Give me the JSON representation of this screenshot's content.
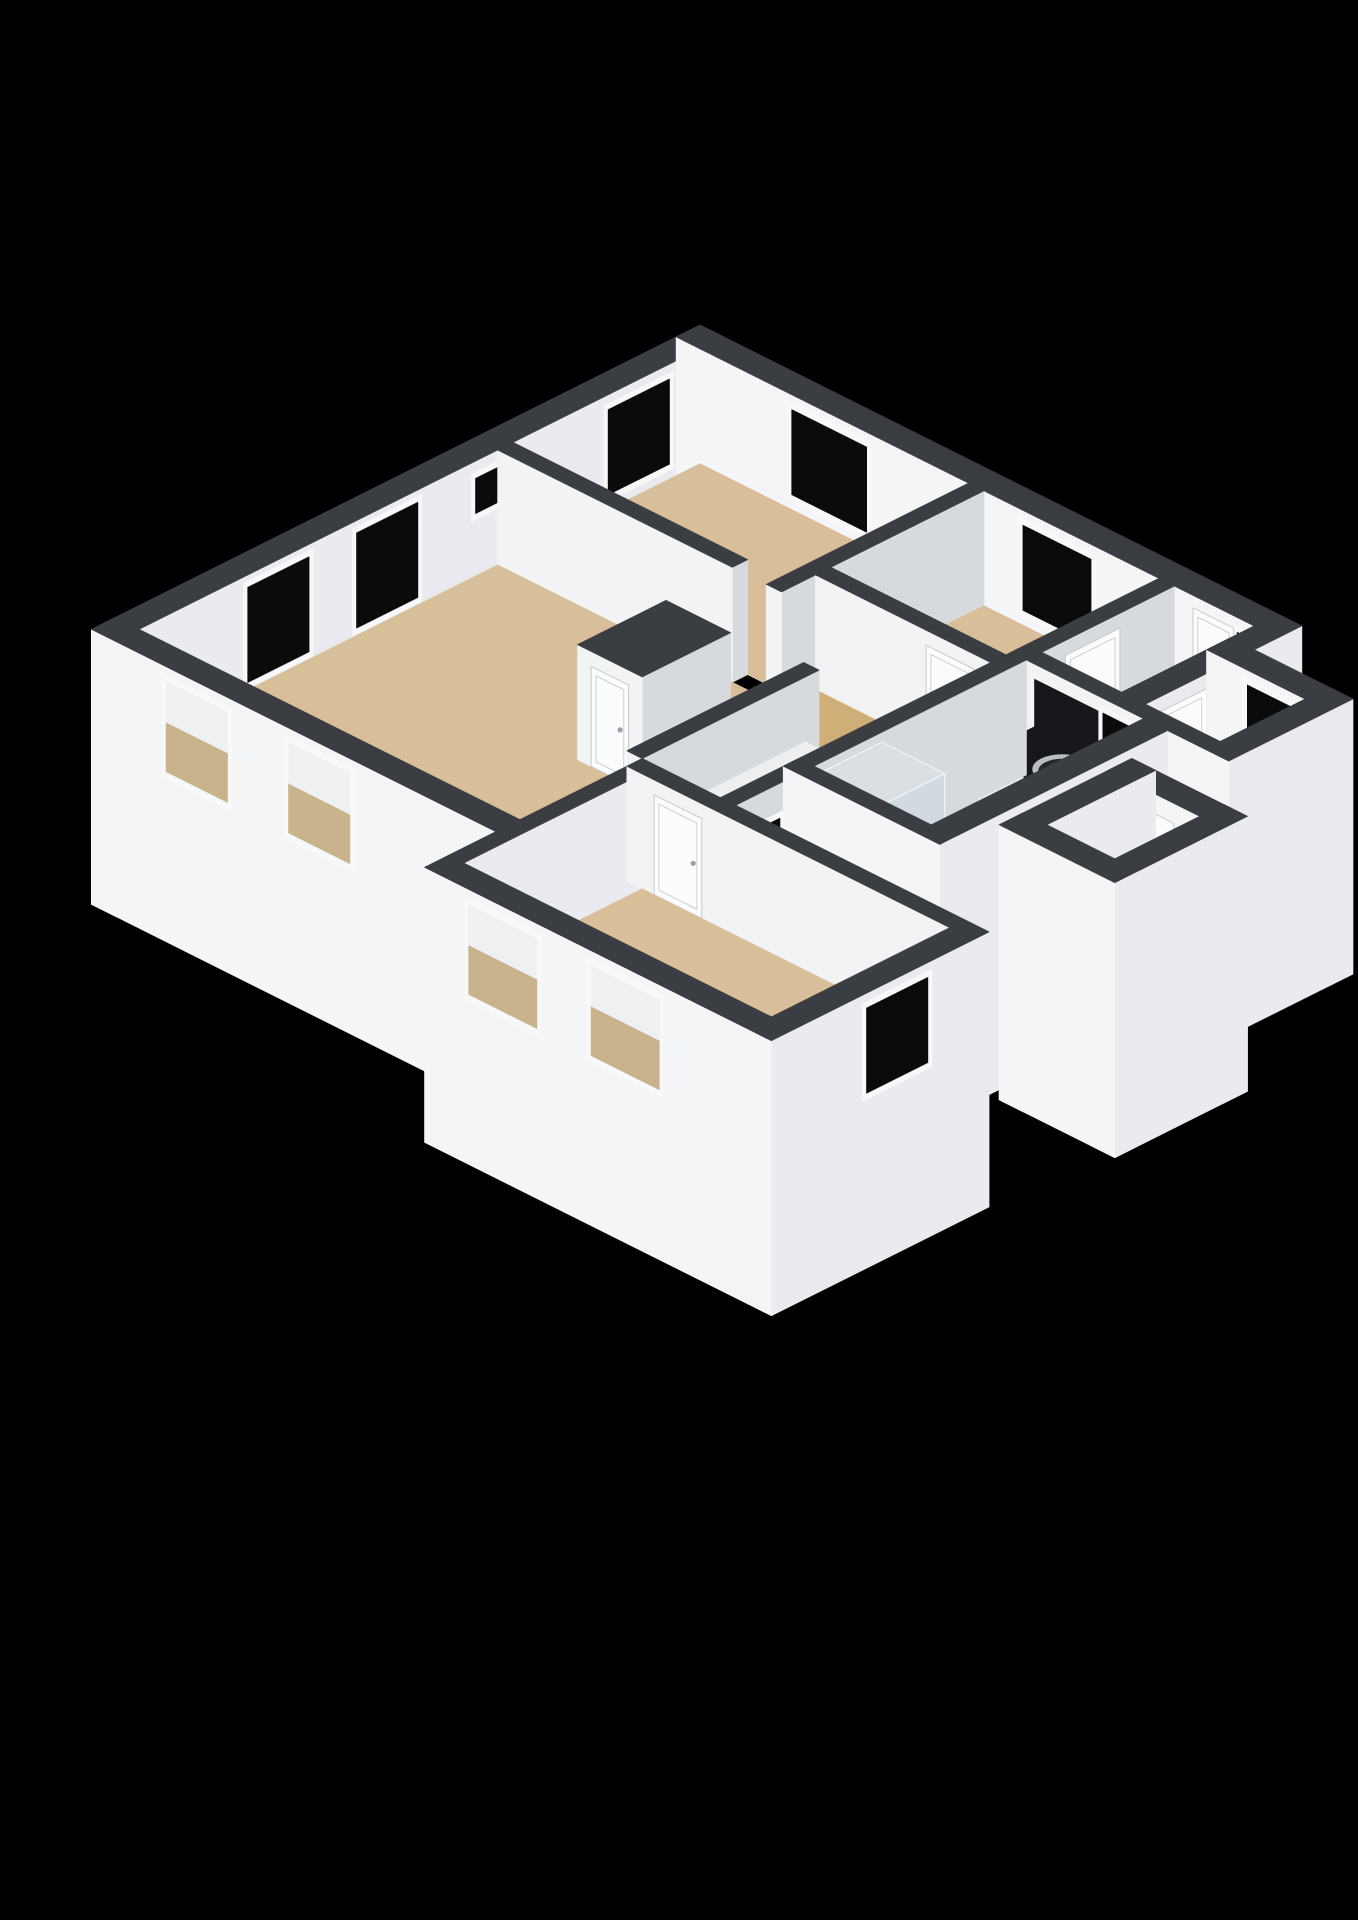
{
  "meta": {
    "type": "isometric-3d-floorplan",
    "background": "#000000"
  },
  "palette": {
    "bg": "#000000",
    "wallTop": "#3a3d41",
    "extFaceY": "#f4f5f7",
    "extFaceX": "#e9ebee",
    "intFaceY": "#f1f3f5",
    "intFaceX": "#d6dadd",
    "floorTan": "#d8bf99",
    "floorHall": "#cfae78",
    "floorBath": "#ccd7e1",
    "floorToilet": "#e1e4e6",
    "floorEntrance": "#e4e5e4",
    "glassDark": "#0a0b0c",
    "frame": "#f7f8fa",
    "openTop": "#eef0f2",
    "openBottom": "#c9b38c",
    "door": "#fbfcfd",
    "doorStroke": "#c6cacd",
    "handle": "#9aa0a5",
    "counterTop": "#15171a",
    "boxSideY": "#f2f3f5",
    "boxSideX": "#e6e8ea",
    "cabinetTop": "#edeff1",
    "showerFill": "rgba(206,220,231,0.42)",
    "showerTopFill": "rgba(228,238,245,0.25)",
    "showerEdge": "#eef2f5",
    "sinkRim": "#b9bdc1",
    "sinkBowl": "#26282b",
    "sinkInner": "#3c3f43",
    "metal": "#c9cdd0"
  },
  "projection": {
    "a": 34,
    "b": 17,
    "h": 50,
    "cx": 700,
    "cy": 440,
    "wallHeight": 2.3,
    "skirt": -3.2
  },
  "floors": [
    {
      "n": "floor-bedroom1",
      "x0": 0.7,
      "y0": 0.7,
      "x1": 8.6,
      "y1": 6.2,
      "c": "floorTan",
      "key": 8.1
    },
    {
      "n": "floor-bedroom2",
      "x0": 9.05,
      "y0": 0.7,
      "x1": 14.2,
      "y1": 5.2,
      "c": "floorTan"
    },
    {
      "n": "floor-entrance",
      "x0": 14.65,
      "y0": 0.7,
      "x1": 17.0,
      "y1": 4.6,
      "c": "floorEntrance"
    },
    {
      "n": "floor-toilet",
      "x0": 17.7,
      "y0": 2.1,
      "x1": 19.9,
      "y1": 4.6,
      "c": "floorToilet"
    },
    {
      "n": "floor-bathroom",
      "x0": 14.65,
      "y0": 5.05,
      "x1": 18.1,
      "y1": 11.3,
      "c": "floorBath",
      "key": 20
    },
    {
      "n": "floor-hall",
      "x0": 9.05,
      "y0": 5.65,
      "x1": 14.2,
      "y1": 13.6,
      "c": "floorHall"
    },
    {
      "n": "floor-living",
      "x0": 0.7,
      "y0": 6.65,
      "x1": 11.9,
      "y1": 17.2,
      "c": "floorTan"
    },
    {
      "n": "floor-bedroom3",
      "x0": 12.35,
      "y0": 14.05,
      "x1": 21.4,
      "y1": 19.3,
      "c": "floorTan"
    },
    {
      "n": "floor-storage",
      "x0": 19.8,
      "y0": 7.1,
      "x1": 21.8,
      "y1": 9.6,
      "c": "floorTan"
    }
  ],
  "walls": [
    {
      "n": "wall-nw-facade",
      "x0": 0,
      "y0": 0,
      "x1": 0.7,
      "y1": 17.9,
      "ext": true,
      "key": 5
    },
    {
      "n": "wall-ne-facade",
      "x0": 0,
      "y0": 0,
      "x1": 17.35,
      "y1": 0.7,
      "ext": true,
      "key": 5.05
    },
    {
      "n": "wall-entrance-east",
      "x0": 17.0,
      "y0": 0,
      "x1": 17.7,
      "y1": 5.05,
      "ext": true
    },
    {
      "n": "wall-toilet-north",
      "x0": 17.0,
      "y0": 1.4,
      "x1": 20.6,
      "y1": 2.1,
      "ext": true
    },
    {
      "n": "wall-toilet-east",
      "x0": 19.9,
      "y0": 1.4,
      "x1": 20.6,
      "y1": 5.05,
      "ext": true
    },
    {
      "n": "wall-bathroom-north",
      "x0": 14.2,
      "y0": 4.6,
      "x1": 18.8,
      "y1": 5.05,
      "ext": false
    },
    {
      "n": "wall-toilet-south",
      "x0": 18.8,
      "y0": 4.6,
      "x1": 20.6,
      "y1": 5.05,
      "ext": true
    },
    {
      "n": "wall-bathroom-east",
      "x0": 18.1,
      "y0": 5.05,
      "x1": 18.8,
      "y1": 11.75,
      "ext": true
    },
    {
      "n": "wall-bathroom-south",
      "x0": 14.2,
      "y0": 11.3,
      "x1": 18.8,
      "y1": 11.75,
      "ext": true
    },
    {
      "n": "wall-corridor-bathroom",
      "x0": 14.2,
      "y0": 5.05,
      "x1": 14.65,
      "y1": 14.05,
      "ext": false
    },
    {
      "n": "wall-bedroom3-north",
      "x0": 11.9,
      "y0": 13.6,
      "x1": 21.4,
      "y1": 14.05,
      "ext": false
    },
    {
      "n": "wall-living-sw-facade",
      "x0": 0,
      "y0": 17.2,
      "x1": 12.35,
      "y1": 17.9,
      "ext": true
    },
    {
      "n": "wall-bedroom3-west",
      "x0": 11.9,
      "y0": 14.05,
      "x1": 12.35,
      "y1": 19.3,
      "ext": true
    },
    {
      "n": "wall-bedroom3-sw-facade",
      "x0": 11.9,
      "y0": 19.3,
      "x1": 21.4,
      "y1": 20.0,
      "ext": true
    },
    {
      "n": "wall-bedroom3-east",
      "x0": 21.4,
      "y0": 13.6,
      "x1": 22.1,
      "y1": 20.0,
      "ext": true
    },
    {
      "n": "wall-living-bedroom1",
      "x0": 0.7,
      "y0": 6.2,
      "x1": 7.6,
      "y1": 6.65,
      "ext": false
    },
    {
      "n": "wall-bedroom1-bedroom2",
      "x0": 8.6,
      "y0": 0.7,
      "x1": 9.05,
      "y1": 6.65,
      "ext": false
    },
    {
      "n": "wall-bedroom2-south",
      "x0": 9.05,
      "y0": 5.2,
      "x1": 14.2,
      "y1": 5.65,
      "ext": false
    },
    {
      "n": "wall-bedroom2-entrance",
      "x0": 14.2,
      "y0": 0.7,
      "x1": 14.65,
      "y1": 5.2,
      "ext": false
    },
    {
      "n": "wall-living-corridor",
      "x0": 11.45,
      "y0": 8.4,
      "x1": 11.9,
      "y1": 13.6,
      "ext": false
    },
    {
      "n": "wall-storage-north",
      "x0": 19.1,
      "y0": 6.4,
      "x1": 22.5,
      "y1": 7.1,
      "ext": true
    },
    {
      "n": "wall-storage-east",
      "x0": 21.8,
      "y0": 6.4,
      "x1": 22.5,
      "y1": 10.3,
      "ext": true
    },
    {
      "n": "wall-storage-south",
      "x0": 19.1,
      "y0": 9.6,
      "x1": 22.5,
      "y1": 10.3,
      "ext": true
    },
    {
      "n": "wall-storage-west",
      "x0": 19.1,
      "y0": 6.4,
      "x1": 19.8,
      "y1": 10.3,
      "ext": true
    }
  ],
  "boxes": [
    {
      "n": "closet-box",
      "x0": 7.6,
      "y0": 8.6,
      "x1": 9.5,
      "y1": 11.2,
      "z0": 0,
      "z1": 2.3,
      "top": "wallTop",
      "fy": "intFaceY",
      "fx": "intFaceX"
    },
    {
      "n": "bathroom-counter",
      "x0": 14.9,
      "y0": 5.05,
      "x1": 18.1,
      "y1": 6.7,
      "z0": 0,
      "z1": 1.05,
      "top": "counterTop",
      "fy": "boxSideY",
      "fx": "boxSideX"
    },
    {
      "n": "hall-cabinet",
      "x0": 11.9,
      "y0": 8.8,
      "x1": 12.7,
      "y1": 13.2,
      "z0": 0,
      "z1": 1.0,
      "top": "cabinetTop",
      "fy": "boxSideY",
      "fx": "boxSideX"
    },
    {
      "n": "shower-enclosure",
      "x0": 14.65,
      "y0": 9.3,
      "x1": 16.5,
      "y1": 11.3,
      "z0": 0,
      "z1": 2.1,
      "glass": true
    }
  ],
  "decals": [
    {
      "n": "window-bedroom1-nw-icon",
      "kind": "window-dark",
      "face": "x",
      "v": 0.7,
      "a0": 1.6,
      "a1": 3.4,
      "z0": 0.3,
      "z1": 2.0,
      "key": 5.15
    },
    {
      "n": "window-living-small-icon",
      "kind": "window-dark",
      "face": "x",
      "v": 0.7,
      "a0": 6.3,
      "a1": 7.3,
      "z0": 1.25,
      "z1": 1.95,
      "key": 5.16
    },
    {
      "n": "window-living-nw-1-icon",
      "kind": "window-dark",
      "face": "x",
      "v": 0.7,
      "a0": 9.0,
      "a1": 10.8,
      "z0": 0.15,
      "z1": 2.05,
      "key": 5.17
    },
    {
      "n": "window-living-nw-2-icon",
      "kind": "window-dark",
      "face": "x",
      "v": 0.7,
      "a0": 12.2,
      "a1": 14.0,
      "z0": 0.15,
      "z1": 2.05,
      "key": 5.18
    },
    {
      "n": "window-bedroom1-ne-icon",
      "kind": "window-dark",
      "face": "y",
      "v": 0.7,
      "a0": 3.4,
      "a1": 5.6,
      "z0": 0.3,
      "z1": 2.0,
      "key": 5.2
    },
    {
      "n": "window-bedroom2-ne-icon",
      "kind": "window-dark",
      "face": "y",
      "v": 0.7,
      "a0": 10.2,
      "a1": 12.2,
      "z0": 0.3,
      "z1": 2.0,
      "key": 5.21
    },
    {
      "n": "window-entrance-side-icon",
      "kind": "window-dark",
      "face": "y",
      "v": 0.7,
      "a0": 16.5,
      "a1": 17.2,
      "z0": 0.3,
      "z1": 2.0,
      "key": 5.22
    },
    {
      "n": "door-entrance",
      "kind": "door",
      "face": "y",
      "v": 0.7,
      "a0": 15.2,
      "a1": 16.4,
      "z0": 0,
      "z1": 2.05,
      "key": 5.23
    },
    {
      "n": "door-toilet",
      "kind": "door",
      "face": "x",
      "v": 17.7,
      "a0": 2.8,
      "a1": 4.2,
      "z0": 0,
      "z1": 2.0,
      "key": 20.03
    },
    {
      "n": "window-toilet-icon",
      "kind": "window-dark",
      "face": "y",
      "v": 2.1,
      "a0": 18.2,
      "a1": 19.6,
      "z0": 0.5,
      "z1": 2.0,
      "key": 20.7
    },
    {
      "n": "bathroom-backsplash",
      "kind": "panel",
      "face": "y",
      "v": 5.06,
      "a0": 14.9,
      "a1": 18.05,
      "z0": 1.05,
      "z1": 2.0,
      "key": 21.48,
      "c": "counterTop"
    },
    {
      "n": "window-bathroom-icon",
      "kind": "window-dark",
      "face": "y",
      "v": 5.05,
      "a0": 16.9,
      "a1": 17.8,
      "z0": 0.9,
      "z1": 2.0,
      "key": 21.55
    },
    {
      "n": "door-bedroom2",
      "kind": "door",
      "face": "y",
      "v": 5.65,
      "a0": 12.3,
      "a1": 13.7,
      "z0": 0,
      "z1": 2.0,
      "key": 17.2
    },
    {
      "n": "door-bedroom2-entrance",
      "kind": "door",
      "face": "x",
      "v": 14.65,
      "a0": 2.3,
      "a1": 3.9,
      "z0": 0,
      "z1": 2.0,
      "key": 17.53
    },
    {
      "n": "door-closet",
      "kind": "door",
      "face": "y",
      "v": 11.2,
      "a0": 8.0,
      "a1": 9.1,
      "z0": 0,
      "z1": 2.0,
      "key": 18.6
    },
    {
      "n": "window-corridor-small-icon",
      "kind": "window-dark",
      "face": "x",
      "v": 14.65,
      "a0": 12.3,
      "a1": 13.2,
      "z0": 0.8,
      "z1": 1.6,
      "key": 24.13
    },
    {
      "n": "window-living-sw-1-icon",
      "kind": "window-open",
      "face": "y",
      "v": 17.9,
      "a0": 2.2,
      "a1": 4.0,
      "z0": 0.2,
      "z1": 2.0,
      "key": 23.88
    },
    {
      "n": "window-living-sw-2-icon",
      "kind": "window-open",
      "face": "y",
      "v": 17.9,
      "a0": 5.8,
      "a1": 7.6,
      "z0": 0.2,
      "z1": 2.0,
      "key": 23.89
    },
    {
      "n": "door-leaf-storage",
      "kind": "leaf",
      "face": "y",
      "v": 7.1,
      "a0": 20.15,
      "a1": 21.25,
      "z0": 0.05,
      "z1": 1.9,
      "key": 27.7
    },
    {
      "n": "door-bedroom3",
      "kind": "door",
      "face": "y",
      "v": 14.05,
      "a0": 12.7,
      "a1": 14.1,
      "z0": 0,
      "z1": 2.0,
      "key": 30.63
    },
    {
      "n": "window-bedroom3-sw-1-icon",
      "kind": "window-open",
      "face": "y",
      "v": 20.0,
      "a0": 13.2,
      "a1": 15.2,
      "z0": 0.2,
      "z1": 2.0,
      "key": 36.45
    },
    {
      "n": "window-bedroom3-sw-2-icon",
      "kind": "window-open",
      "face": "y",
      "v": 20.0,
      "a0": 16.8,
      "a1": 18.8,
      "z0": 0.2,
      "z1": 2.0,
      "key": 36.46
    },
    {
      "n": "window-bedroom3-se-icon",
      "kind": "window-dark",
      "face": "x",
      "v": 22.1,
      "a0": 15.4,
      "a1": 17.2,
      "z0": 0.3,
      "z1": 2.0,
      "key": 38.7
    }
  ],
  "fixtures": {
    "sink": {
      "n": "sink-basin",
      "cx": 16.55,
      "cy": 5.9,
      "z": 1.05,
      "r": 0.62,
      "key": 22.5
    },
    "faucet": {
      "n": "faucet",
      "x": 17.5,
      "y": 5.45,
      "s": 0.17,
      "z0": 1.05,
      "z1": 1.78,
      "key": 22.6
    }
  }
}
